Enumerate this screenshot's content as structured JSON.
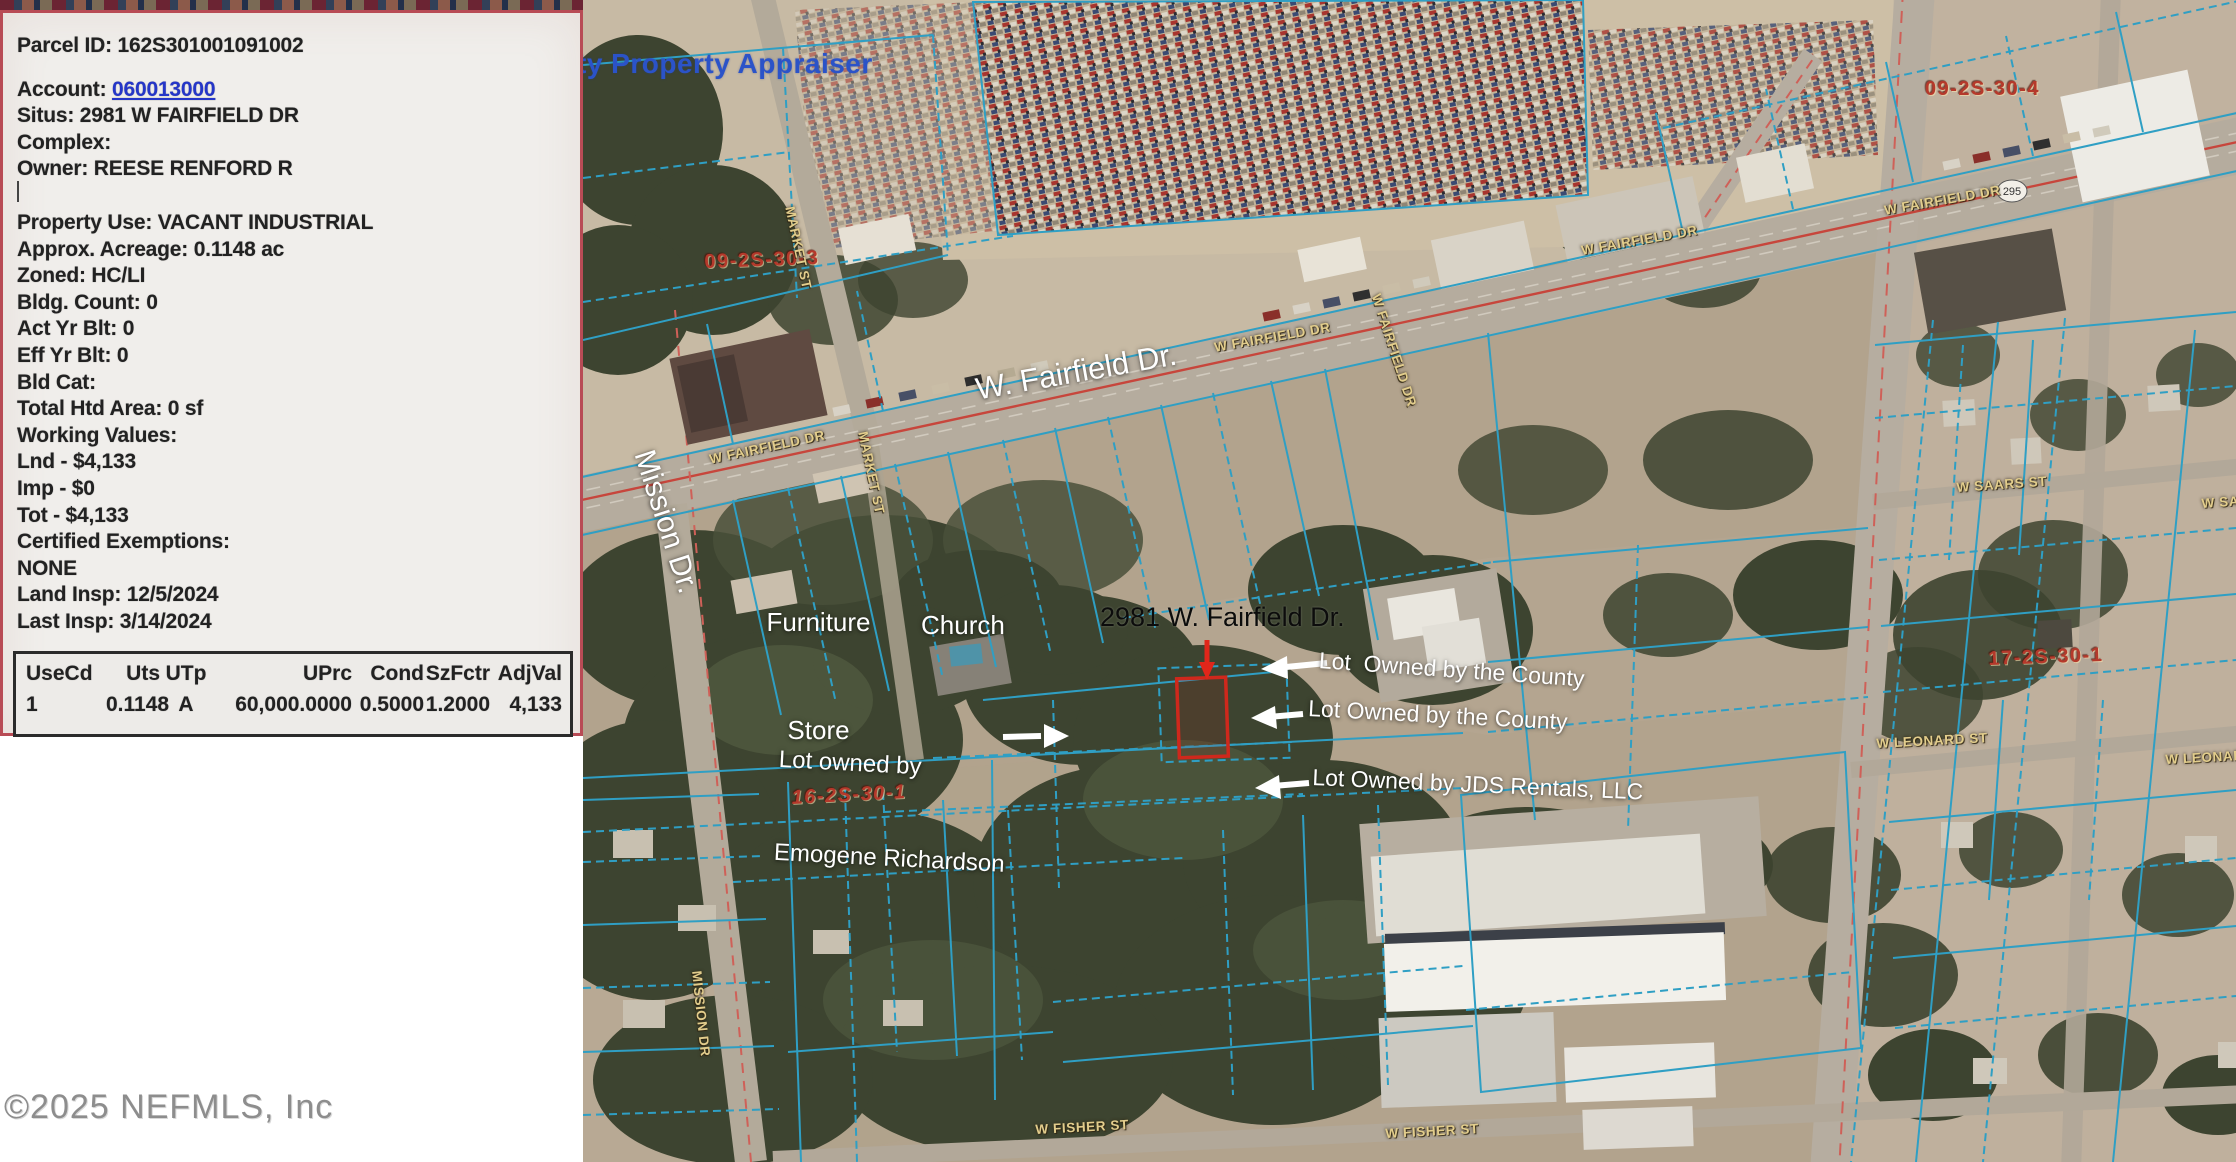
{
  "panel": {
    "parcel_id_line": "Parcel ID: 162S301001091002",
    "account_label": "Account: ",
    "account_number": "060013000",
    "lines": [
      "Situs: 2981 W FAIRFIELD DR",
      "Complex:",
      "Owner: REESE RENFORD R",
      "Property Use: VACANT INDUSTRIAL",
      "Approx. Acreage: 0.1148 ac",
      "Zoned: HC/LI",
      "Bldg. Count: 0",
      "Act Yr Blt: 0",
      "Eff Yr Blt: 0",
      "Bld Cat:",
      "Total Htd Area: 0 sf",
      "Working Values:",
      "Lnd - $4,133",
      "Imp - $0",
      "Tot - $4,133",
      "Certified Exemptions:",
      "NONE",
      "Land Insp: 12/5/2024",
      "Last Insp: 3/14/2024"
    ],
    "table": {
      "headers": [
        "UseCd",
        "Uts",
        "UTp",
        "UPrc",
        "Cond",
        "SzFctr",
        "AdjVal"
      ],
      "row": [
        "1",
        "0.1148",
        "A",
        "60,000.0000",
        "0.5000",
        "1.2000",
        "4,133"
      ]
    }
  },
  "map": {
    "watermark": "ty Property Appraiser",
    "annotations": {
      "main_road": "W. Fairfield Dr.",
      "cross_road": "Mission Dr.",
      "furniture_line1": "Furniture",
      "furniture_line2": "Store",
      "church": "Church",
      "subject_address": "2981 W. Fairfield Dr.",
      "county_lot_1": "Lot  Owned by the County",
      "county_lot_2": "Lot Owned by the County",
      "jds_lot": "Lot Owned by JDS Rentals, LLC",
      "richardson_line1": "Lot owned by",
      "richardson_line2": "Emogene Richardson"
    },
    "section_labels": {
      "nw": "09-2S-30-3",
      "ne": "09-2S-30-4",
      "sw": "16-2S-30-1",
      "se": "17-2S-30-1"
    },
    "streets": {
      "fairfield": "W FAIRFIELD DR",
      "market": "MARKET ST",
      "mission": "MISSION DR",
      "saars": "W SAARS ST",
      "leonard": "W LEONARD ST",
      "fisher": "W FISHER ST"
    },
    "road_shield": "295",
    "colors": {
      "parcel_line": "#2f9fc4",
      "subject_outline": "#cf281c",
      "section_label": "#b5392b",
      "street_label": "#e2cd8c",
      "account_link": "#2536c8",
      "watermark": "#2b53c8"
    }
  },
  "footer": {
    "copyright": "©2025 NEFMLS, Inc"
  }
}
